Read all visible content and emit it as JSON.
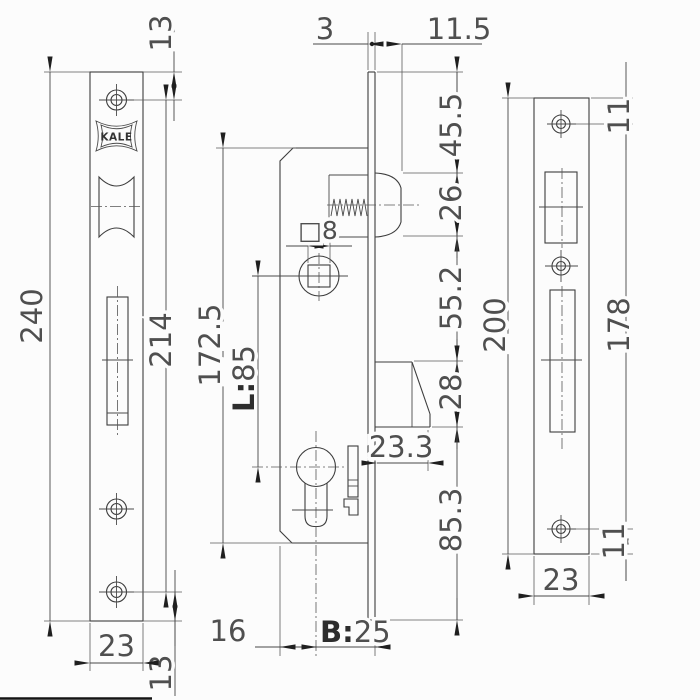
{
  "drawing": {
    "brand_logo": "KALE",
    "left_faceplate": {
      "top_screw_offset": "13",
      "overall_height": "240",
      "screw_span": "214",
      "width": "23",
      "bottom_screw_offset": "13"
    },
    "lock_case": {
      "case_height": "172.5",
      "centers_prefix": "L:",
      "centers_value": "85",
      "spindle_square": "□8",
      "bolt_throw": "23.3",
      "case_edge_to_cylinder": "16",
      "backset_prefix": "B:",
      "backset_value": "25"
    },
    "edge_chain": {
      "faceplate_thickness": "3",
      "roller_projection": "11.5",
      "top_to_roller": "45.5",
      "roller_opening": "26",
      "roller_to_bolt": "55.2",
      "bolt_opening": "28",
      "bolt_to_bottom": "85.3"
    },
    "strike_plate": {
      "top_screw_offset": "11",
      "overall_height": "200",
      "screw_span": "178",
      "bottom_screw_offset": "11",
      "width": "23"
    }
  }
}
